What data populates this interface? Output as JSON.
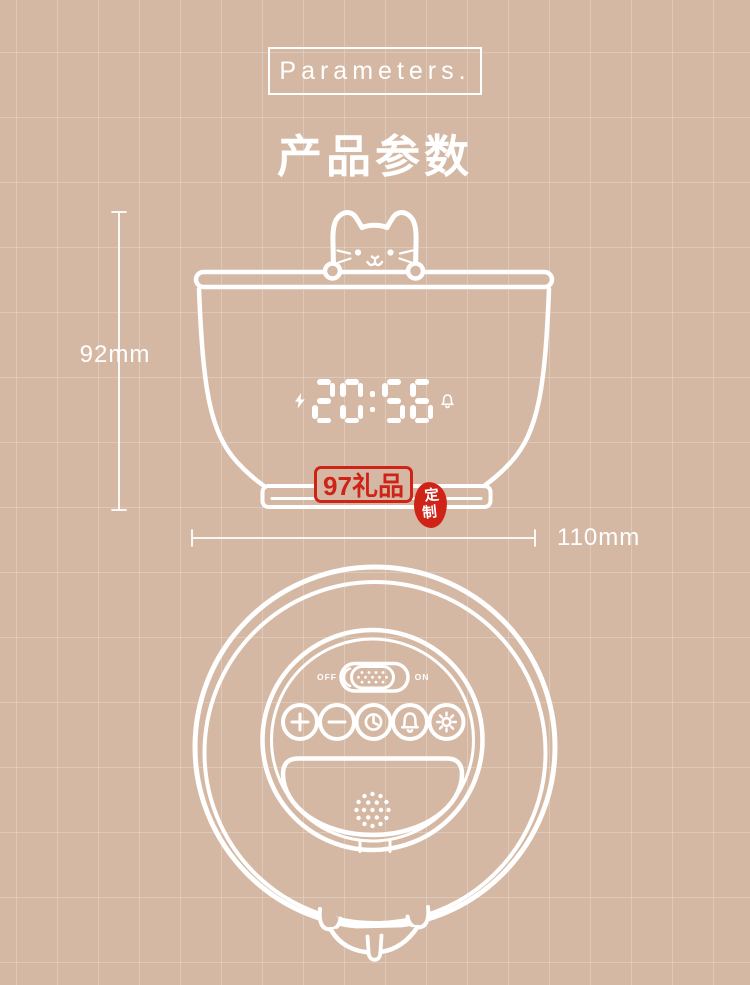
{
  "colors": {
    "background": "#d5b8a3",
    "line_art": "#ffffff",
    "accent_red": "#cf2318"
  },
  "header": {
    "tag": "Parameters.",
    "title": "产品参数"
  },
  "front_view": {
    "height_label": "92mm",
    "width_label": "110mm",
    "clock_time": "20:56",
    "clock_icons": [
      "charging-bolt",
      "alarm-bell"
    ]
  },
  "watermark": {
    "brand": "97礼品",
    "seal_char_1": "定",
    "seal_char_2": "制"
  },
  "bottom_view": {
    "switch_off": "OFF",
    "switch_on": "ON",
    "buttons": [
      "plus",
      "minus",
      "time-set",
      "alarm",
      "brightness"
    ]
  }
}
